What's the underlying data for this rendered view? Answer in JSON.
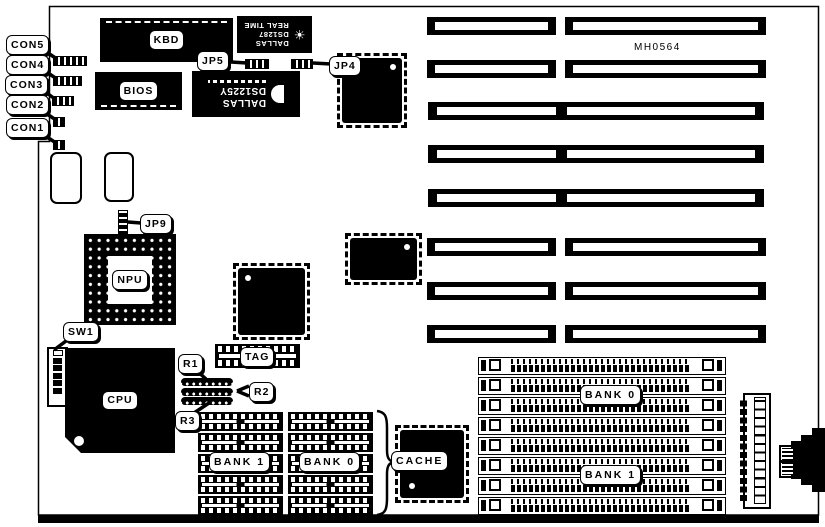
{
  "board": {
    "part_number": "MH0564",
    "callouts": {
      "con5": "CON5",
      "con4": "CON4",
      "con3": "CON3",
      "con2": "CON2",
      "con1": "CON1",
      "jp5": "JP5",
      "jp4": "JP4",
      "jp9": "JP9",
      "sw1": "SW1",
      "r1": "R1",
      "r2": "R2",
      "r3": "R3"
    },
    "chips": {
      "kbd": "KBD",
      "bios": "BIOS",
      "npu": "NPU",
      "cpu": "CPU",
      "tag": "TAG",
      "cache": "CACHE",
      "rtc": {
        "brand": "DALLAS",
        "model": "DS1287",
        "type": "REAL TIME"
      },
      "nvram": {
        "brand": "DALLAS",
        "model": "DS1225Y"
      }
    },
    "memory": {
      "dram_bank_left": "BANK 1",
      "dram_bank_right": "BANK 0",
      "simm_bank_top": "BANK 0",
      "simm_bank_bottom": "BANK 1"
    },
    "colors": {
      "ink": "#000000",
      "paper": "#ffffff"
    }
  }
}
